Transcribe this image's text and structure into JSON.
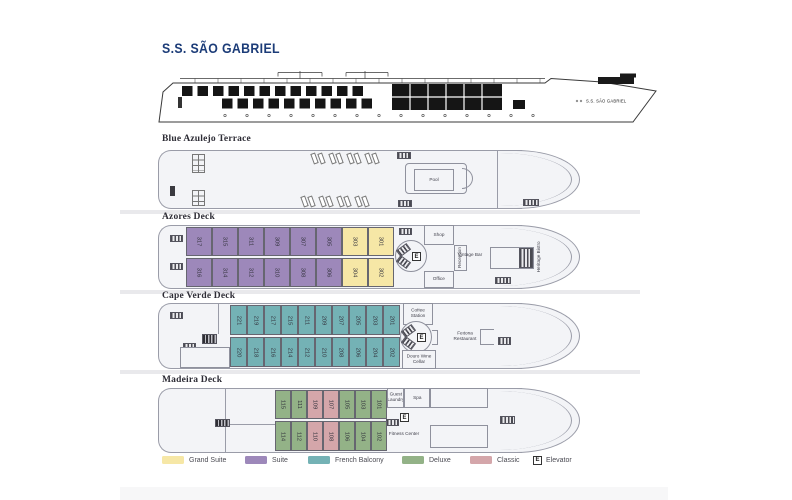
{
  "title": "S.S. SÃO GABRIEL",
  "ship_profile_label": "S.S. SÃO GABRIEL",
  "elevator_letter": "E",
  "colors": {
    "title": "#1c3c78",
    "grand": "#f6e7a6",
    "suite": "#9d88ba",
    "french": "#74b2b5",
    "deluxe": "#93b287",
    "classic": "#d4a6aa",
    "deck_fill": "#f3f4f7",
    "deck_border": "#9a9ca8"
  },
  "decks": {
    "terrace": {
      "name": "Blue Azulejo Terrace",
      "pool_label": "Pool"
    },
    "azores": {
      "name": "Azores Deck",
      "cabins_top": [
        {
          "num": "317",
          "type": "suite"
        },
        {
          "num": "315",
          "type": "suite"
        },
        {
          "num": "311",
          "type": "suite"
        },
        {
          "num": "309",
          "type": "suite"
        },
        {
          "num": "307",
          "type": "suite"
        },
        {
          "num": "305",
          "type": "suite"
        },
        {
          "num": "303",
          "type": "grand"
        },
        {
          "num": "301",
          "type": "grand"
        }
      ],
      "cabins_bottom": [
        {
          "num": "316",
          "type": "suite"
        },
        {
          "num": "314",
          "type": "suite"
        },
        {
          "num": "312",
          "type": "suite"
        },
        {
          "num": "310",
          "type": "suite"
        },
        {
          "num": "308",
          "type": "suite"
        },
        {
          "num": "306",
          "type": "suite"
        },
        {
          "num": "304",
          "type": "grand"
        },
        {
          "num": "302",
          "type": "grand"
        }
      ],
      "rooms": {
        "shop": "Shop",
        "reception": "Reception",
        "office": "Office",
        "vintage_bar": "Vintage Bar",
        "heritage_bistro": "Heritage Bistro"
      }
    },
    "cape": {
      "name": "Cape Verde Deck",
      "cabins_top": [
        {
          "num": "221",
          "type": "french"
        },
        {
          "num": "219",
          "type": "french"
        },
        {
          "num": "217",
          "type": "french"
        },
        {
          "num": "215",
          "type": "french"
        },
        {
          "num": "211",
          "type": "french"
        },
        {
          "num": "209",
          "type": "french"
        },
        {
          "num": "207",
          "type": "french"
        },
        {
          "num": "205",
          "type": "french"
        },
        {
          "num": "203",
          "type": "french"
        },
        {
          "num": "201",
          "type": "french"
        }
      ],
      "cabins_bottom": [
        {
          "num": "220",
          "type": "french"
        },
        {
          "num": "218",
          "type": "french"
        },
        {
          "num": "216",
          "type": "french"
        },
        {
          "num": "214",
          "type": "french"
        },
        {
          "num": "212",
          "type": "french"
        },
        {
          "num": "210",
          "type": "french"
        },
        {
          "num": "208",
          "type": "french"
        },
        {
          "num": "206",
          "type": "french"
        },
        {
          "num": "204",
          "type": "french"
        },
        {
          "num": "202",
          "type": "french"
        }
      ],
      "rooms": {
        "coffee_station": "Coffee Station",
        "wine_cellar": "Douro Wine Cellar",
        "restaurant": "Feitoria Restaurant"
      }
    },
    "madeira": {
      "name": "Madeira Deck",
      "cabins_top": [
        {
          "num": "115",
          "type": "deluxe"
        },
        {
          "num": "111",
          "type": "deluxe"
        },
        {
          "num": "109",
          "type": "classic"
        },
        {
          "num": "107",
          "type": "classic"
        },
        {
          "num": "105",
          "type": "deluxe"
        },
        {
          "num": "103",
          "type": "deluxe"
        },
        {
          "num": "101",
          "type": "deluxe"
        }
      ],
      "cabins_bottom": [
        {
          "num": "114",
          "type": "deluxe"
        },
        {
          "num": "112",
          "type": "deluxe"
        },
        {
          "num": "110",
          "type": "classic"
        },
        {
          "num": "108",
          "type": "classic"
        },
        {
          "num": "106",
          "type": "deluxe"
        },
        {
          "num": "104",
          "type": "deluxe"
        },
        {
          "num": "102",
          "type": "deluxe"
        }
      ],
      "rooms": {
        "guest_laundry": "Guest Laundry",
        "spa": "Spa",
        "fitness_center": "Fitness Center"
      }
    }
  },
  "legend": {
    "items": [
      {
        "key": "grand",
        "label": "Grand Suite"
      },
      {
        "key": "suite",
        "label": "Suite"
      },
      {
        "key": "french",
        "label": "French Balcony"
      },
      {
        "key": "deluxe",
        "label": "Deluxe"
      },
      {
        "key": "classic",
        "label": "Classic"
      },
      {
        "key": "elevator",
        "label": "Elevator"
      }
    ]
  }
}
